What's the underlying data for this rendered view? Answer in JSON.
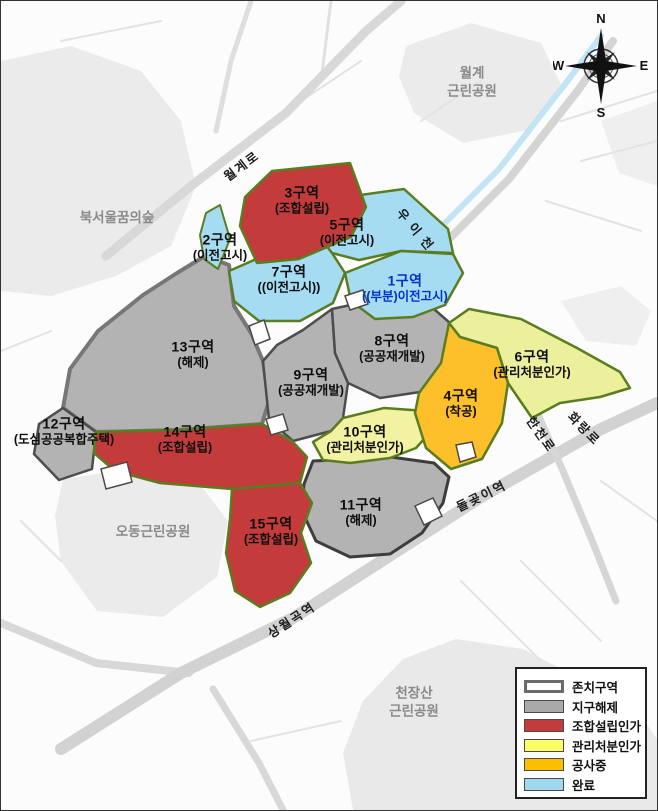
{
  "compass": {
    "n": "N",
    "e": "E",
    "s": "S",
    "w": "W"
  },
  "colors": {
    "completed_fill": "#a5dcf2",
    "dismissed_fill": "#b3b3b3",
    "union_fill": "#c43b3b",
    "approved_fill": "#eeef9e",
    "construction_fill": "#fdc02a",
    "zone_border_green": "#5a7d1f",
    "zone_border_gray": "#4d4d4d",
    "zone1_label_blue": "#0033cc",
    "stream_blue": "#c2e4f4"
  },
  "zones": [
    {
      "name": "1구역",
      "status": "((부분)이전고시)",
      "fill": "#a5dcf2"
    },
    {
      "name": "2구역",
      "status": "(이전고시)",
      "fill": "#a5dcf2"
    },
    {
      "name": "3구역",
      "status": "(조합설립)",
      "fill": "#c43b3b"
    },
    {
      "name": "4구역",
      "status": "(착공)",
      "fill": "#fdc02a"
    },
    {
      "name": "5구역",
      "status": "(이전고시)",
      "fill": "#a5dcf2"
    },
    {
      "name": "6구역",
      "status": "(관리처분인가)",
      "fill": "#ecef9b"
    },
    {
      "name": "7구역",
      "status": "((이전고시))",
      "fill": "#a5dcf2"
    },
    {
      "name": "8구역",
      "status": "(공공재개발)",
      "fill": "#b3b3b3"
    },
    {
      "name": "9구역",
      "status": "(공공재개발)",
      "fill": "#b3b3b3"
    },
    {
      "name": "10구역",
      "status": "(관리처분인가)",
      "fill": "#f2f2a2"
    },
    {
      "name": "11구역",
      "status": "(해제)",
      "fill": "#b3b3b3"
    },
    {
      "name": "12구역",
      "status": "(도심공공복합주택)",
      "fill": "#b3b3b3"
    },
    {
      "name": "13구역",
      "status": "(해제)",
      "fill": "#b3b3b3"
    },
    {
      "name": "14구역",
      "status": "(조합설립)",
      "fill": "#c43b3b"
    },
    {
      "name": "15구역",
      "status": "(조합설립)",
      "fill": "#c43b3b"
    }
  ],
  "parks": [
    {
      "line1": "월계",
      "line2": "근린공원"
    },
    {
      "line1": "북서울꿈의숲",
      "line2": ""
    },
    {
      "line1": "오동근린공원",
      "line2": ""
    },
    {
      "line1": "천장산",
      "line2": "근린공원"
    }
  ],
  "roads": [
    {
      "name": "월계로"
    },
    {
      "name": "우이천"
    },
    {
      "name": "한천로"
    },
    {
      "name": "화랑로"
    }
  ],
  "stations": [
    {
      "name": "돌곶이역"
    },
    {
      "name": "상월곡역"
    }
  ],
  "legend": {
    "items": [
      {
        "label": "존치구역",
        "color": "#ffffff"
      },
      {
        "label": "지구해제",
        "color": "#a9a9a9"
      },
      {
        "label": "조합설립인가",
        "color": "#c43b3b"
      },
      {
        "label": "관리처분인가",
        "color": "#fdfd66"
      },
      {
        "label": "공사중",
        "color": "#fcbf00"
      },
      {
        "label": "완료",
        "color": "#a0d8f0"
      }
    ]
  }
}
